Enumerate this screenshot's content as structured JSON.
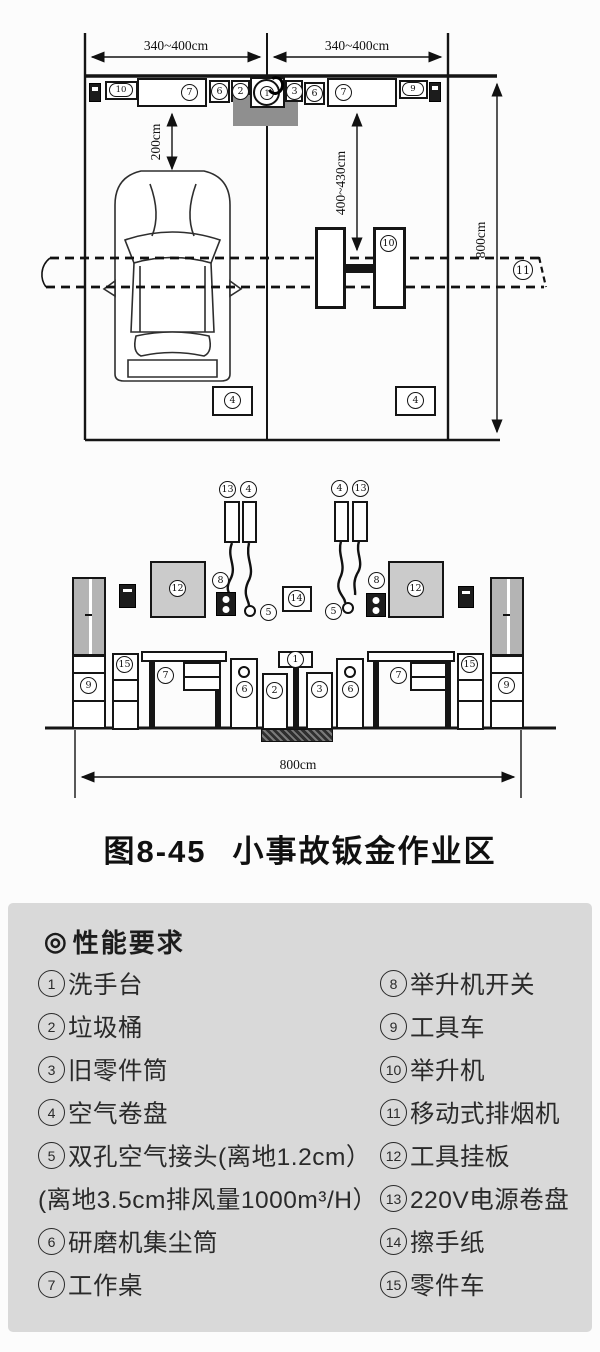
{
  "figure": {
    "number": "图8-45",
    "title": "小事故钣金作业区"
  },
  "plan": {
    "dims": {
      "bay_left": "340~400cm",
      "bay_right": "340~400cm",
      "depth": "800cm",
      "wall_to_car": "200cm",
      "wall_to_lift": "400~430cm"
    },
    "wall_items": [
      "10",
      "7",
      "6",
      "2",
      "1",
      "3",
      "6",
      "7",
      "9"
    ],
    "lift": "10",
    "exhaust": "11",
    "air_reel_left": "4",
    "air_reel_right": "4"
  },
  "elevation": {
    "dims": {
      "width": "800cm"
    },
    "hang_left": [
      "13",
      "4"
    ],
    "hang_right": [
      "4",
      "13"
    ],
    "board_left": "12",
    "board_right": "12",
    "switch_left": "8",
    "switch_right": "8",
    "coupler_left": "5",
    "coupler_right": "5",
    "towel": "14",
    "floor_row": [
      "9",
      "15",
      "7",
      "6",
      "2",
      "1",
      "3",
      "6",
      "7",
      "15",
      "9"
    ]
  },
  "legend": {
    "bullet": "◎",
    "heading": "性能要求",
    "left": [
      {
        "num": "1",
        "text": "洗手台"
      },
      {
        "num": "2",
        "text": "垃圾桶"
      },
      {
        "num": "3",
        "text": "旧零件筒"
      },
      {
        "num": "4",
        "text": "空气卷盘"
      },
      {
        "num": "5",
        "text": "双孔空气接头(离地1.2cm）"
      },
      {
        "num": "",
        "text": "(离地3.5cm排风量1000m³/H）"
      },
      {
        "num": "6",
        "text": "研磨机集尘筒"
      },
      {
        "num": "7",
        "text": "工作桌"
      }
    ],
    "right": [
      {
        "num": "8",
        "text": "举升机开关"
      },
      {
        "num": "9",
        "text": "工具车"
      },
      {
        "num": "10",
        "text": "举升机"
      },
      {
        "num": "11",
        "text": "移动式排烟机"
      },
      {
        "num": "12",
        "text": "工具挂板"
      },
      {
        "num": "13",
        "text": "220V电源卷盘"
      },
      {
        "num": "14",
        "text": "擦手纸"
      },
      {
        "num": "15",
        "text": "零件车"
      }
    ]
  }
}
